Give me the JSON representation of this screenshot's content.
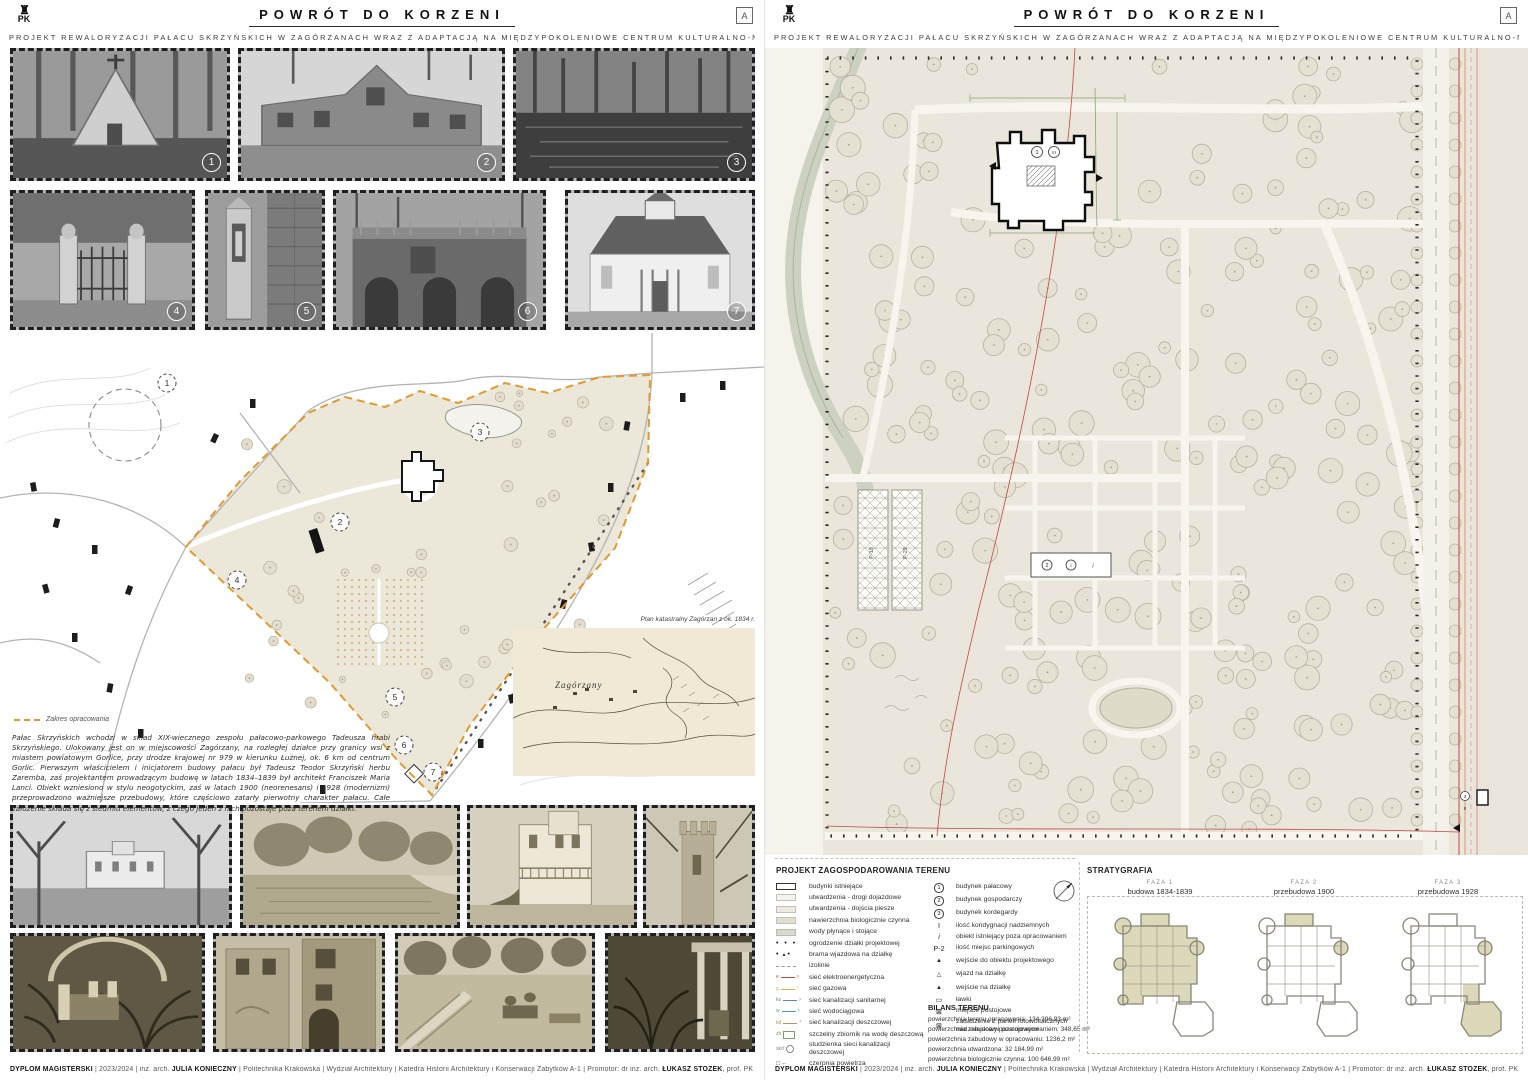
{
  "header": {
    "title": "POWRÓT DO KORZENI",
    "subtitle": "PROJEKT REWALORYZACJI PAŁACU SKRZYŃSKICH W ZAGÓRZANACH WRAZ Z ADAPTACJĄ NA MIĘDZYPOKOLENIOWE CENTRUM KULTURALNO-NAUKOWE",
    "logo_left": "PK",
    "logo_right": "A"
  },
  "footer": {
    "program": "DYPLOM MAGISTERSKI",
    "sep1": " | 2023/2024 | inż. arch. ",
    "author": "JULIA KONIECZNY",
    "middle": " | Politechnika Krakowska | Wydział Architektury | Katedra Historii Architektury i Konserwacji Zabytków A-1 | Promotor: dr inż. arch. ",
    "promoter": "ŁUKASZ STOŻEK",
    "suffix": ", prof. PK"
  },
  "left_board": {
    "photo_numbers": [
      "1",
      "2",
      "3",
      "4",
      "5",
      "6",
      "7"
    ],
    "site_plan": {
      "zakres_label": "Zakres opracowania",
      "markers": [
        "1",
        "2",
        "3",
        "4",
        "5",
        "6",
        "7"
      ],
      "map_caption": "Plan katastralny Zagórzan z ok. 1834 r.",
      "map_label": "Zagórzany"
    },
    "description": "Pałac Skrzyńskich wchodzi w skład XIX-wiecznego zespołu pałacowo-parkowego Tadeusza hrabi Skrzyńskiego. Ulokowany jest on w miejscowości Zagórzany, na rozległej działce przy granicy wsi z miastem powiatowym Gorlice, przy drodze krajowej nr 979 w kierunku Łużnej, ok. 6 km od centrum Gorlic. Pierwszym właścicielem i inicjatorem budowy pałacu był Tadeusz Teodor Skrzyński herbu Zaremba, zaś projektantem prowadzącym budowę w latach 1834–1839 był architekt Franciszek Maria Lanci. Obiekt wzniesiono w stylu neogotyckim, zaś w latach 1900 (neorenesans) i 1928 (modernizm) przeprowadzono ważniejsze przebudowy, które częściowo zatarły pierwotny charakter pałacu. Całe założenie składa się z siedmiu elementów, z czego jeden z nich pozostaje poza terenem działki."
  },
  "right_board": {
    "plan": {
      "palace_no": "1",
      "palace_storeys": "III",
      "parking_left": "P-18",
      "parking_right": "P-29",
      "outbuilding_no": "2",
      "outbuilding_storeys": "I",
      "outbuilding_flag": "i",
      "kordegarda_no": "3",
      "kordegarda_storeys": "II"
    },
    "legend": {
      "title": "PROJEKT ZAGOSPODAROWANIA TERENU",
      "col1": [
        {
          "kind": "swatch",
          "cls": "sw-exist",
          "icon": "existing-building-swatch",
          "label": "budynki istniejące"
        },
        {
          "kind": "swatch",
          "cls": "sw-road",
          "icon": "road-swatch",
          "label": "utwardzenia - drogi dojazdowe"
        },
        {
          "kind": "swatch",
          "cls": "sw-walk",
          "icon": "footpath-swatch",
          "label": "utwardzenia - dojścia piesze"
        },
        {
          "kind": "swatch",
          "cls": "sw-bio",
          "icon": "bio-surface-swatch",
          "label": "nawierzchnia biologicznie czynna"
        },
        {
          "kind": "swatch",
          "cls": "sw-water",
          "icon": "water-swatch",
          "label": "wody płynące i stojące"
        },
        {
          "kind": "dots",
          "icon": "fence-dots-icon",
          "label": "ogrodzenie działki projektowej"
        },
        {
          "kind": "gate",
          "icon": "gate-icon",
          "label": "brama wjazdowa na działkę"
        },
        {
          "kind": "iso",
          "icon": "isoline-icon",
          "label": "izolinie"
        },
        {
          "kind": "net",
          "color": "#c0493c",
          "tag": "e",
          "icon": "power-line-icon",
          "label": "sieć elektroenergetyczna"
        },
        {
          "kind": "net",
          "color": "#d3b44c",
          "tag": "g",
          "icon": "gas-line-icon",
          "label": "sieć gazowa"
        },
        {
          "kind": "net",
          "color": "#5b86b8",
          "tag": "ks",
          "icon": "sanitary-sewer-line-icon",
          "label": "sieć kanalizacji sanitarnej"
        },
        {
          "kind": "net",
          "color": "#49a0ad",
          "tag": "w",
          "icon": "water-main-line-icon",
          "label": "sieć wodociągowa"
        },
        {
          "kind": "net",
          "color": "#a89a52",
          "tag": "kd",
          "icon": "storm-sewer-line-icon",
          "label": "sieć kanalizacji deszczowej"
        },
        {
          "kind": "zb",
          "tag": "zb",
          "icon": "rain-tank-icon",
          "label": "szczelny zbiornik na wodę deszczową"
        },
        {
          "kind": "skd",
          "tag": "skd",
          "icon": "storm-manhole-icon",
          "label": "studzienka sieci kanalizacji deszczowej"
        },
        {
          "kind": "czerpnia",
          "icon": "air-intake-icon",
          "label": "czerpnia powietrza"
        }
      ],
      "col2": [
        {
          "style": "circ",
          "glyph": "1",
          "icon": "circled-1-icon",
          "label": "budynek pałacowy"
        },
        {
          "style": "circ",
          "glyph": "2",
          "icon": "circled-2-icon",
          "label": "budynek gospodarczy"
        },
        {
          "style": "circ",
          "glyph": "3",
          "icon": "circled-3-icon",
          "label": "budynek kordegardy"
        },
        {
          "style": "txt",
          "glyph": "I",
          "icon": "storeys-count-icon",
          "label": "ilość kondygnacji nadziemnych"
        },
        {
          "style": "txt-i",
          "glyph": "i",
          "icon": "outside-scope-icon",
          "label": "obiekt istniejący poza opracowaniem"
        },
        {
          "style": "txt",
          "glyph": "P-2",
          "icon": "parking-count-icon",
          "label": "ilość miejsc parkingowych"
        },
        {
          "style": "tri",
          "glyph": "▲",
          "icon": "building-entrance-icon",
          "label": "wejście do obiektu projektowego"
        },
        {
          "style": "tri",
          "glyph": "△",
          "icon": "site-driveway-icon",
          "label": "wjazd na działkę"
        },
        {
          "style": "tri",
          "glyph": "▲",
          "icon": "site-entrance-icon",
          "label": "wejście na działkę"
        },
        {
          "style": "txt",
          "glyph": "▭",
          "icon": "bench-icon",
          "label": "ławki"
        },
        {
          "style": "txt",
          "glyph": "⊠",
          "icon": "parking-spot-icon",
          "label": "miejsce postojowe"
        },
        {
          "style": "txt",
          "glyph": "⊠",
          "icon": "pv-canopy-icon",
          "label": "zadaszenie z paneli fotowoltaicznych nad miejscami postojowymi"
        }
      ]
    },
    "bilans": {
      "title": "BILANS TERENU",
      "lines": [
        "powierzchnia terenu opracowania: 134 396,93 m²",
        "powierzchnia zabudowy poza opracowaniem: 348,65 m²",
        "powierzchnia zabudowy w opracowaniu: 1236,2 m²",
        "powierzchnia utwardzona: 32 184,99 m²",
        "powierzchnia biologicznie czynna: 100 646,99 m²"
      ]
    },
    "strat": {
      "title": "STRATYGRAFIA",
      "phases": [
        {
          "name": "FAZA 1",
          "desc": "budowa 1834-1839"
        },
        {
          "name": "FAZA 2",
          "desc": "przebudowa 1900"
        },
        {
          "name": "FAZA 3",
          "desc": "przebudowa 1928"
        }
      ]
    }
  }
}
